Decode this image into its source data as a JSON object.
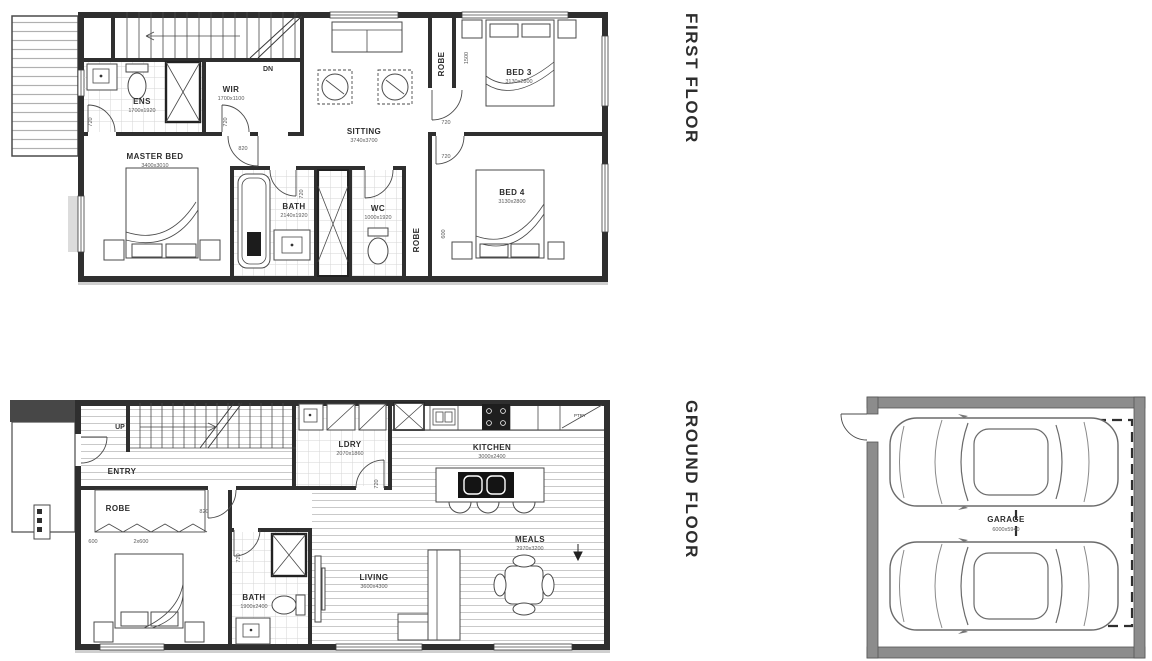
{
  "palette": {
    "floor_label_color": "#5e7d88",
    "ink": "#3a3a3a",
    "wall_fill": "#2f2f2f",
    "garage_wall_fill": "#8c8c8c",
    "hatch_gray": "#c8c8c8",
    "tile_gray": "#d6d6d6"
  },
  "titles": {
    "first": "FIRST FLOOR",
    "ground": "GROUND FLOOR"
  },
  "labels": {
    "robe": "ROBE"
  },
  "first_floor": {
    "stairs_label": "DN",
    "rooms": {
      "ens": {
        "name": "ENS",
        "dim": "1700x1920"
      },
      "wir": {
        "name": "WIR",
        "dim": "1700x1100"
      },
      "sitting": {
        "name": "SITTING",
        "dim": "3740x3700"
      },
      "master_bed": {
        "name": "MASTER BED",
        "dim": "3400x3010"
      },
      "bath": {
        "name": "BATH",
        "dim": "2140x1920"
      },
      "wc": {
        "name": "WC",
        "dim": "1000x1920"
      },
      "bed3": {
        "name": "BED 3",
        "dim": "3130x2800"
      },
      "bed4": {
        "name": "BED 4",
        "dim": "3130x2800"
      }
    }
  },
  "ground_floor": {
    "stairs_label": "UP",
    "rooms": {
      "entry": {
        "name": "ENTRY"
      },
      "robe": {
        "name": "ROBE"
      },
      "bed2": {
        "name": "BED 2",
        "dim": "3060x3020"
      },
      "bath": {
        "name": "BATH",
        "dim": "1900x2400"
      },
      "ldry": {
        "name": "LDRY",
        "dim": "2070x1860"
      },
      "kitchen": {
        "name": "KITCHEN",
        "dim": "3000x2400"
      },
      "ptry": {
        "name": "PTRY"
      },
      "meals": {
        "name": "MEALS",
        "dim": "2970x3200"
      },
      "living": {
        "name": "LIVING",
        "dim": "3600x4300"
      }
    }
  },
  "garage": {
    "name": "GARAGE",
    "dim": "6000x5940"
  },
  "marks": {
    "720": "720",
    "820": "820",
    "600": "600",
    "2x600": "2x600",
    "1500": "1500"
  }
}
